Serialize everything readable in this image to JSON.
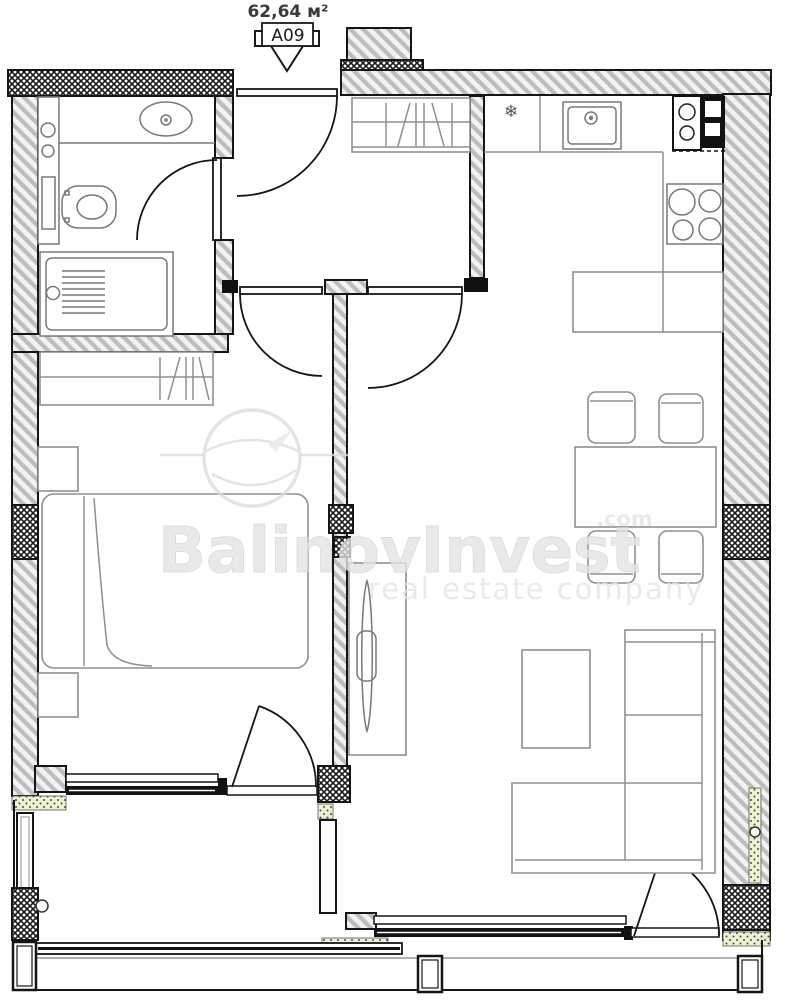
{
  "plan": {
    "area_label": "62,64 м²",
    "unit_label": "A09"
  },
  "watermark": {
    "brand": "BalinovInvest",
    "domain_suffix": ".com",
    "tagline": "real estate company"
  },
  "icons": {
    "snowflake": "❄"
  },
  "colors": {
    "wall_line": "#151515",
    "hatch_fill": "#bdbdbd",
    "crosshatch_line": "#1a1a1a",
    "stipple_fill": "#eef0d8",
    "furniture_line": "#8f8f8f",
    "fixture_line": "#787878",
    "watermark_gray": "#e4e4e4",
    "background": "#ffffff"
  }
}
